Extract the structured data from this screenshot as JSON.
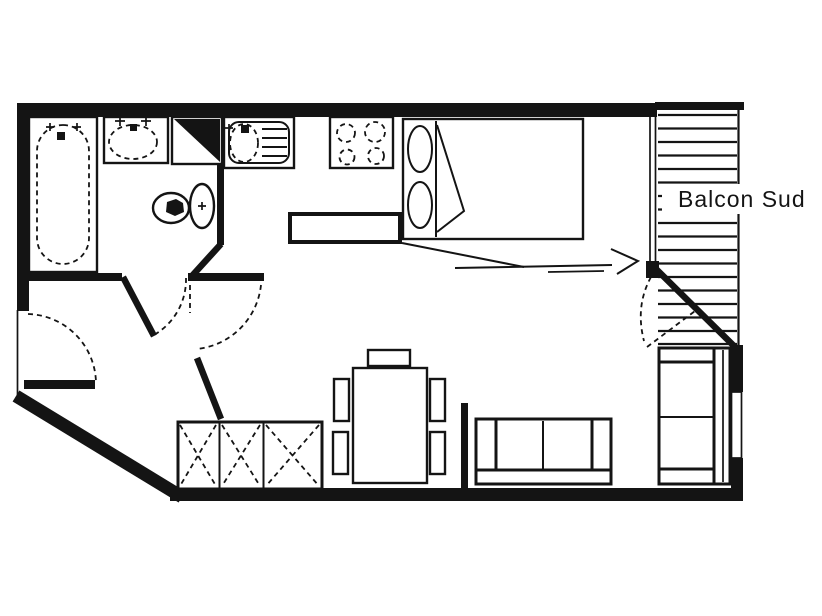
{
  "floorplan": {
    "balcony_label": "Balcon Sud",
    "colors": {
      "line": "#141414",
      "background": "#ffffff"
    },
    "fixtures": [
      "bathtub",
      "washbasin",
      "water-heater",
      "toilet",
      "kitchen-sink",
      "stove-hob",
      "double-bed",
      "kitchen-counter",
      "dining-table",
      "dining-chair",
      "sofa",
      "loveseat",
      "wardrobe",
      "balcony-railing",
      "window",
      "entry-door",
      "bathroom-door",
      "living-room-door",
      "balcony-door",
      "direction-arrow"
    ]
  }
}
